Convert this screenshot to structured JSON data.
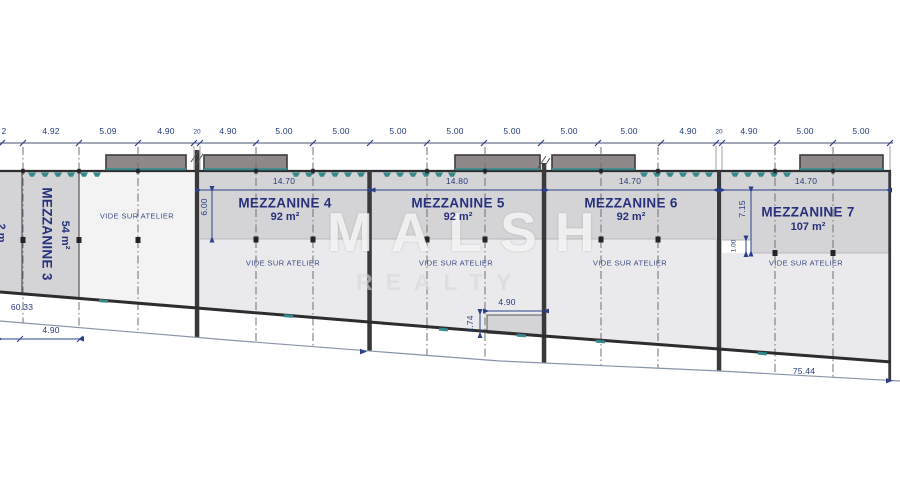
{
  "dwg": {
    "title_hint": "mezzanine floor plan",
    "top_dims": [
      "2",
      "4.92",
      "5.09",
      "4.90",
      "20",
      "4.90",
      "5.00",
      "5.00",
      "5.00",
      "5.00",
      "5.00",
      "5.00",
      "5.00",
      "4.90",
      "20",
      "4.90",
      "5.00",
      "5.00"
    ],
    "mezzanines": [
      {
        "name": "MEZZANINE 3",
        "area": "54 m²"
      },
      {
        "name": "MEZZANINE 4",
        "area": "92 m²",
        "width_label": "14.70",
        "depth_label": "6.00",
        "vide": "VIDE SUR ATELIER"
      },
      {
        "name": "MEZZANINE 5",
        "area": "92 m²",
        "width_label": "14.80",
        "vide": "VIDE SUR ATELIER"
      },
      {
        "name": "MEZZANINE 6",
        "area": "92 m²",
        "width_label": "14.70",
        "vide": "VIDE SUR ATELIER"
      },
      {
        "name": "MEZZANINE 7",
        "area": "107 m²",
        "width_label": "14.70",
        "depth_label": "7.15",
        "step_label": "1.00",
        "vide": "VIDE SUR ATELIER"
      }
    ],
    "vide_left": "VIDE SUR ATELIER",
    "edge_fragment": "2 m",
    "bottom_dims": {
      "total_left": "60.33",
      "left_bay": "4.90",
      "box_width": "4.90",
      "box_height": "1.74",
      "total_right": "75.44"
    },
    "watermark": {
      "line1": "MALSH",
      "line2": "REALTY"
    },
    "colors": {
      "teal": "#35898c",
      "navy_label": "#27317c",
      "dim_blue": "#243c7d",
      "band_grey": "#d4d4d7",
      "zone_light": "#eaeaed",
      "roof_fill": "#8e8889",
      "dark_line": "#2d2d2f"
    }
  }
}
